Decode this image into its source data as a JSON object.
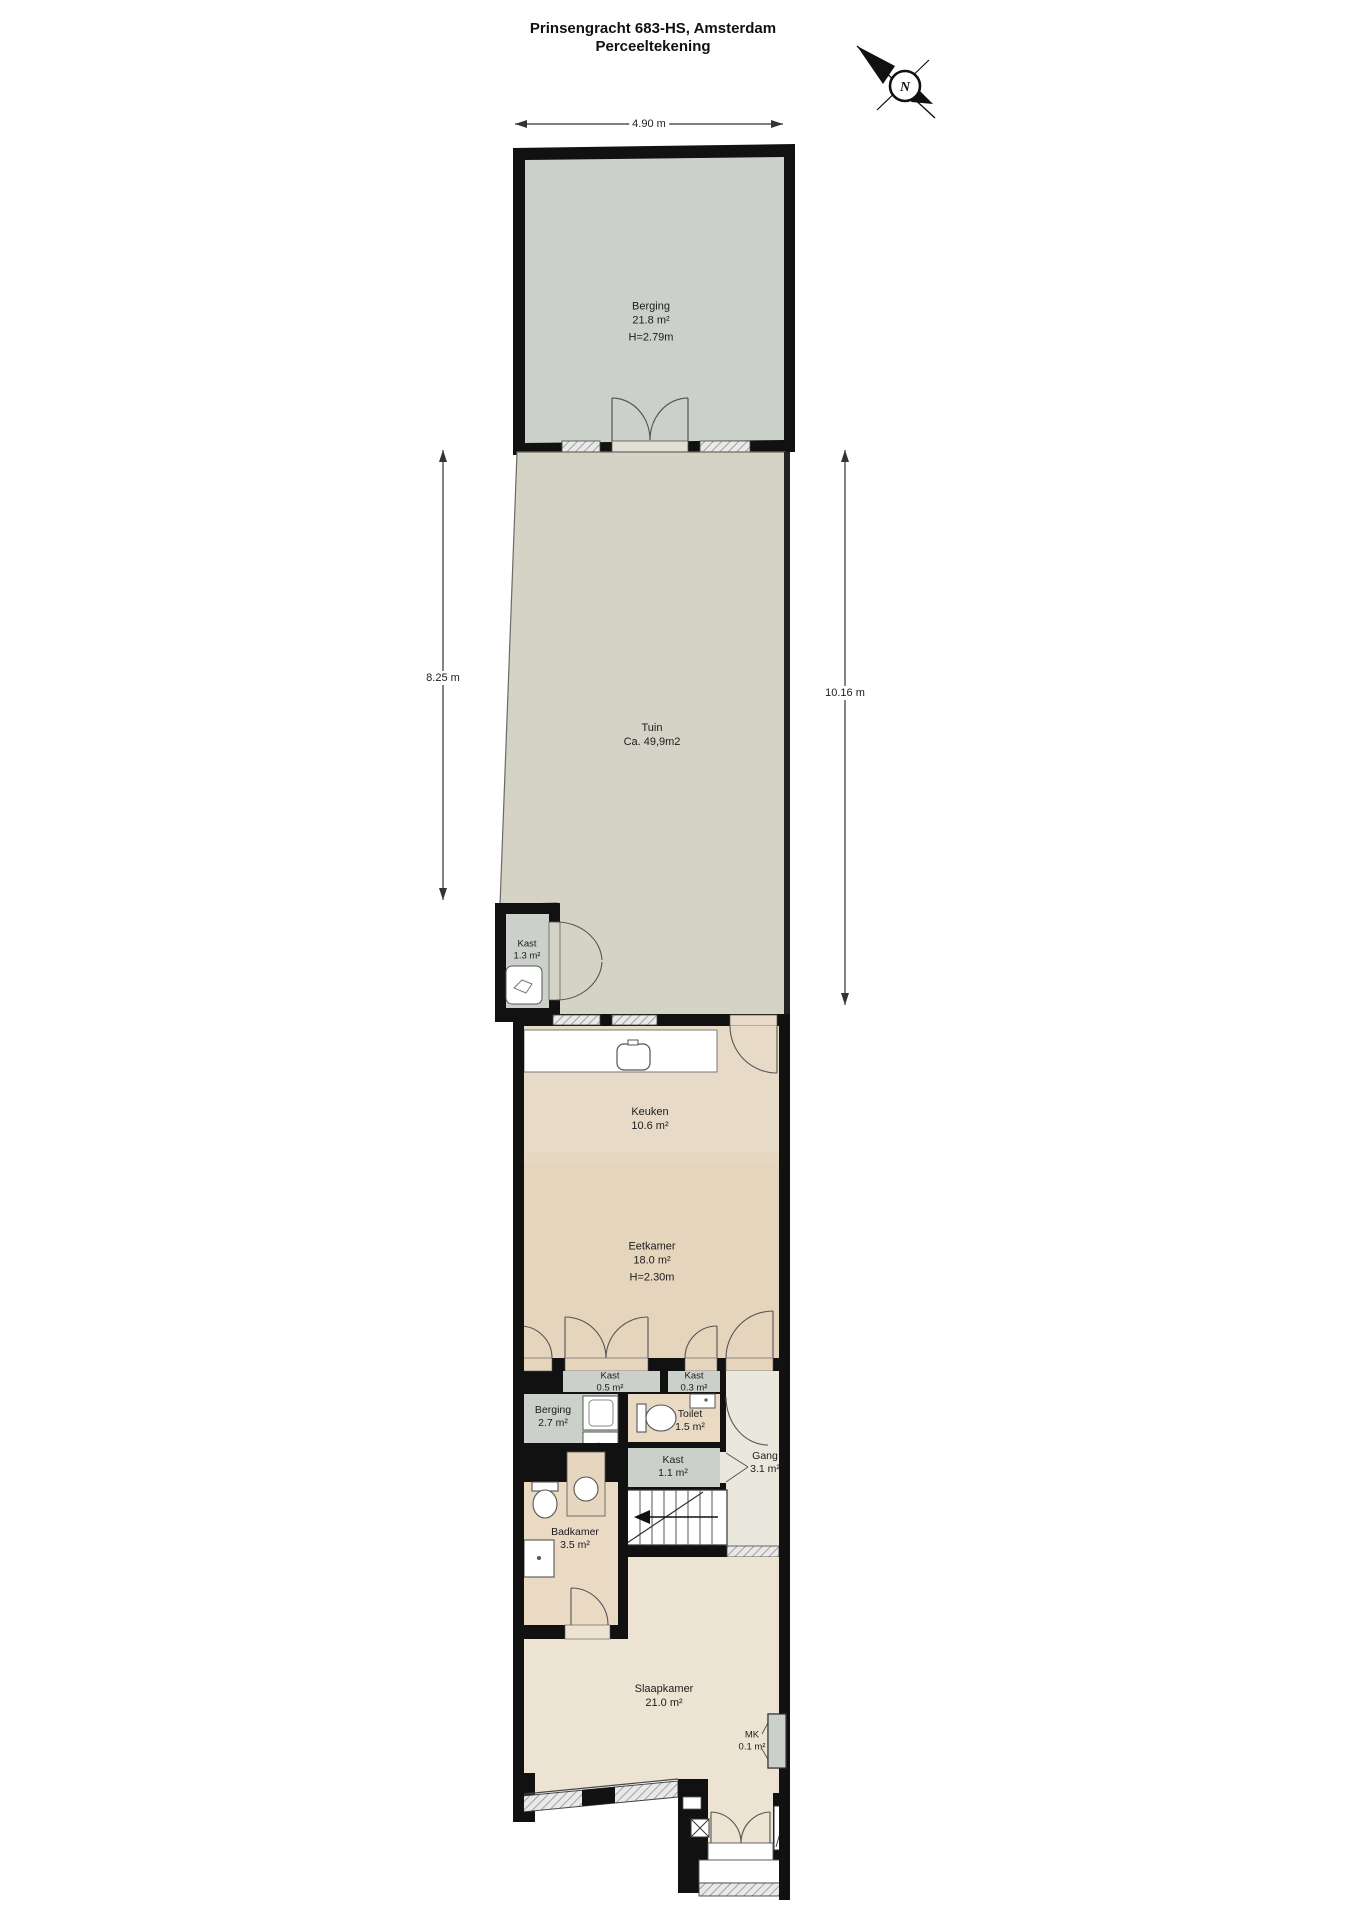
{
  "title": {
    "line1": "Prinsengracht 683-HS, Amsterdam",
    "line2": "Perceeltekening"
  },
  "compass": {
    "letter": "N"
  },
  "dimensions": {
    "top": "4.90 m",
    "left": "8.25 m",
    "right": "10.16 m"
  },
  "rooms": {
    "berging_top": {
      "name": "Berging",
      "area": "21.8 m²",
      "height": "H=2.79m"
    },
    "tuin": {
      "name": "Tuin",
      "area": "Ca. 49,9m2"
    },
    "kast_tuin": {
      "name": "Kast",
      "area": "1.3 m²"
    },
    "keuken": {
      "name": "Keuken",
      "area": "10.6 m²"
    },
    "eetkamer": {
      "name": "Eetkamer",
      "area": "18.0 m²",
      "height": "H=2.30m"
    },
    "kast_05": {
      "name": "Kast",
      "area": "0.5 m²"
    },
    "kast_03": {
      "name": "Kast",
      "area": "0.3 m²"
    },
    "berging_2": {
      "name": "Berging",
      "area": "2.7 m²"
    },
    "toilet": {
      "name": "Toilet",
      "area": "1.5 m²"
    },
    "kast_11": {
      "name": "Kast",
      "area": "1.1 m²"
    },
    "gang": {
      "name": "Gang",
      "area": "3.1 m²"
    },
    "badkamer": {
      "name": "Badkamer",
      "area": "3.5 m²"
    },
    "slaapkamer": {
      "name": "Slaapkamer",
      "area": "21.0 m²"
    },
    "mk": {
      "name": "MK",
      "area": "0.1 m²"
    }
  },
  "colors": {
    "wall": "#111111",
    "storage_gray": "#ccd0ca",
    "tuin": "#d5d3c5",
    "keuken": "#e7dbc7",
    "eetkamer": "#e5d5bd",
    "bathroom_tan": "#ead9c3",
    "gang": "#eae8dd",
    "slaapkamer": "#ece3d3",
    "window_fill": "#e9e9e9"
  }
}
